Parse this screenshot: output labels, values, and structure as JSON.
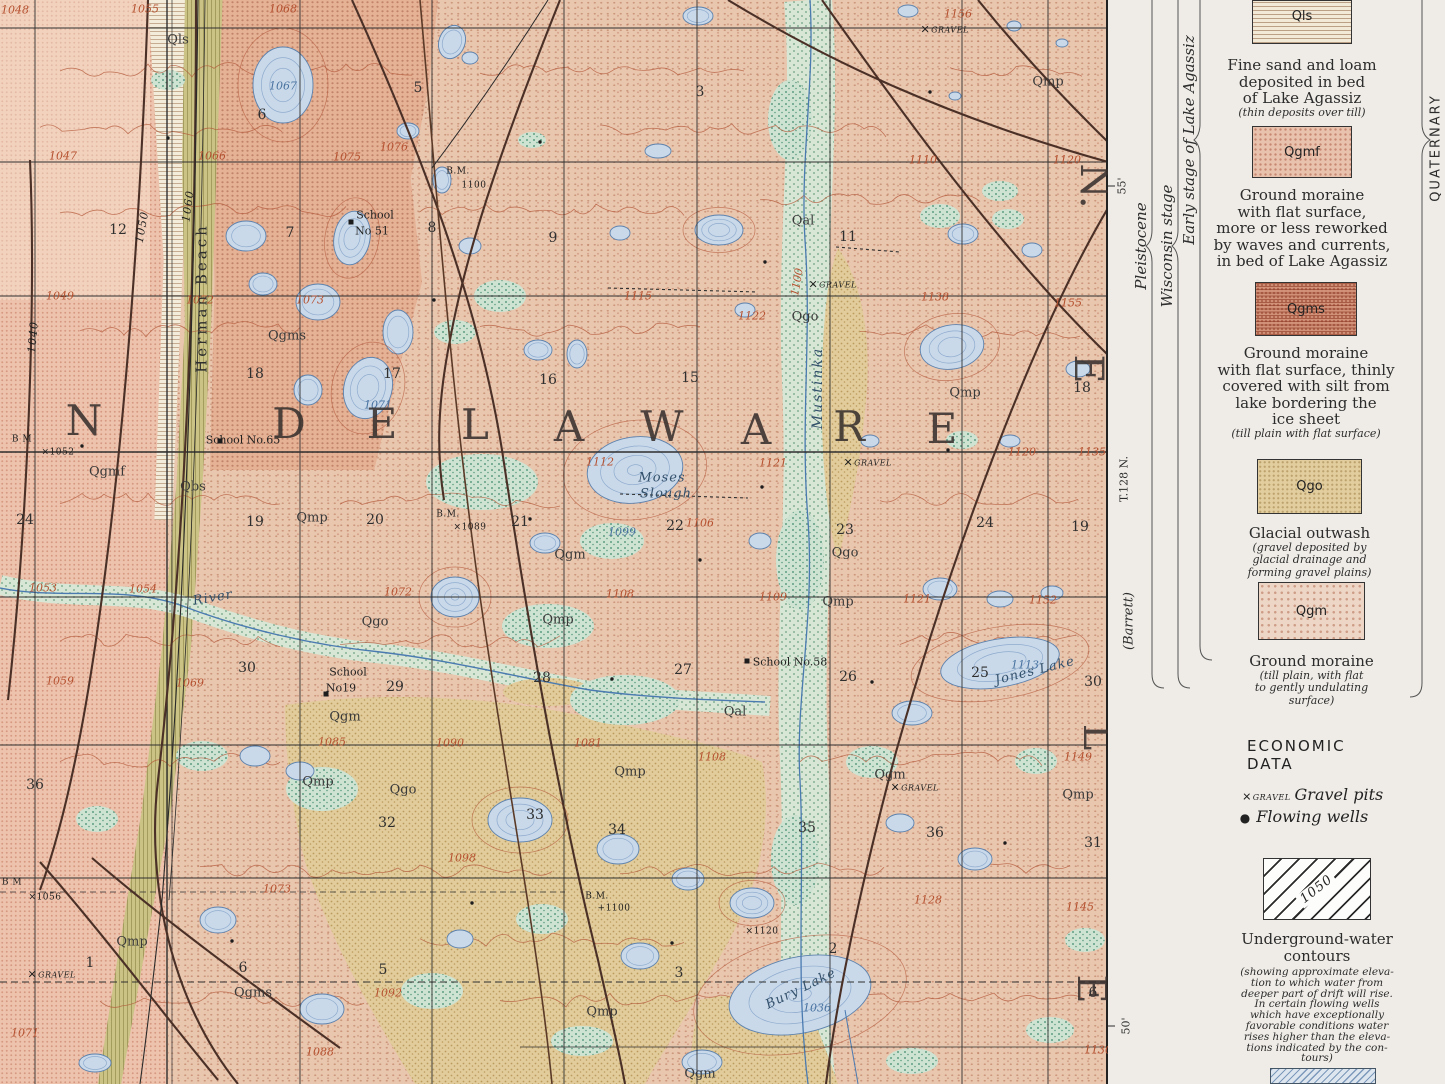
{
  "map": {
    "township_name_letters": [
      {
        "t": "N",
        "x": 85,
        "y": 421
      },
      {
        "t": "D",
        "x": 290,
        "y": 424
      },
      {
        "t": "E",
        "x": 383,
        "y": 424
      },
      {
        "t": "L",
        "x": 476,
        "y": 425
      },
      {
        "t": "A",
        "x": 570,
        "y": 427
      },
      {
        "t": "W",
        "x": 663,
        "y": 427
      },
      {
        "t": "A",
        "x": 757,
        "y": 430
      },
      {
        "t": "R",
        "x": 850,
        "y": 427
      },
      {
        "t": "E",
        "x": 943,
        "y": 429
      }
    ],
    "edge_letters": [
      {
        "t": "N.",
        "x": 1094,
        "y": 186
      },
      {
        "t": "E",
        "x": 1088,
        "y": 369
      },
      {
        "t": "L",
        "x": 1097,
        "y": 737
      },
      {
        "t": "E",
        "x": 1091,
        "y": 989
      }
    ],
    "water_names": [
      [
        "Moses",
        662,
        478,
        "w",
        0
      ],
      [
        "Slough",
        666,
        494,
        "w",
        0
      ],
      [
        "Jones Lake",
        1035,
        671,
        "w",
        -14
      ],
      [
        "Bury Lake",
        801,
        989,
        "w",
        -26
      ],
      [
        "River",
        213,
        598,
        "w",
        -10
      ],
      [
        "Herman Beach",
        202,
        298,
        "vw",
        -90
      ],
      [
        "Mustinka",
        818,
        388,
        "vwi",
        -90
      ]
    ],
    "schools": [
      [
        "School",
        375,
        215
      ],
      [
        "No 51",
        372,
        231
      ],
      [
        "School No.65",
        243,
        440
      ],
      [
        "School",
        348,
        672
      ],
      [
        "No19",
        341,
        688
      ],
      [
        "School No.58",
        790,
        662
      ]
    ],
    "unit_labels": [
      [
        "Qls",
        178,
        40
      ],
      [
        "Qmp",
        1048,
        82
      ],
      [
        "Qal",
        803,
        221
      ],
      [
        "Qgo",
        805,
        317
      ],
      [
        "Qgms",
        287,
        336
      ],
      [
        "Qgmf",
        107,
        472
      ],
      [
        "Qbs",
        193,
        487
      ],
      [
        "Qmp",
        312,
        518
      ],
      [
        "Qgm",
        570,
        555
      ],
      [
        "Qgo",
        845,
        553
      ],
      [
        "Qgo",
        375,
        622
      ],
      [
        "Qmp",
        558,
        620
      ],
      [
        "Qmp",
        838,
        602
      ],
      [
        "Qmp",
        965,
        393
      ],
      [
        "Qgm",
        345,
        717
      ],
      [
        "Qal",
        735,
        712
      ],
      [
        "Qmp",
        318,
        782
      ],
      [
        "Qmp",
        630,
        772
      ],
      [
        "Qgo",
        403,
        790
      ],
      [
        "Qgm",
        890,
        775
      ],
      [
        "Qmp",
        1078,
        795
      ],
      [
        "Qmp",
        132,
        942
      ],
      [
        "Qgms",
        253,
        993
      ],
      [
        "Qmp",
        602,
        1012
      ],
      [
        "Qgm",
        700,
        1074
      ]
    ],
    "contour_elevations_red": [
      [
        "1048",
        15,
        10
      ],
      [
        "1055",
        145,
        9
      ],
      [
        "1068",
        283,
        9
      ],
      [
        "1047",
        63,
        156
      ],
      [
        "1066",
        212,
        156
      ],
      [
        "1075",
        347,
        157
      ],
      [
        "1076",
        394,
        147
      ],
      [
        "1049",
        60,
        296
      ],
      [
        "1072",
        200,
        300
      ],
      [
        "1073",
        310,
        300
      ],
      [
        "1115",
        638,
        296
      ],
      [
        "1122",
        752,
        316
      ],
      [
        "1138",
        935,
        297
      ],
      [
        "1155",
        1068,
        303
      ],
      [
        "1110",
        923,
        160
      ],
      [
        "1120",
        1067,
        160
      ],
      [
        "1156",
        958,
        14
      ],
      [
        "1112",
        600,
        462
      ],
      [
        "1121",
        773,
        463
      ],
      [
        "1120",
        1022,
        452
      ],
      [
        "1135",
        1092,
        452
      ],
      [
        "1106",
        700,
        523
      ],
      [
        "1108",
        620,
        594
      ],
      [
        "1109",
        773,
        597
      ],
      [
        "1121",
        917,
        599
      ],
      [
        "1152",
        1043,
        600
      ],
      [
        "1053",
        43,
        588
      ],
      [
        "1054",
        143,
        589
      ],
      [
        "1072",
        398,
        592
      ],
      [
        "1059",
        60,
        681
      ],
      [
        "1069",
        190,
        683
      ],
      [
        "1085",
        332,
        742
      ],
      [
        "1090",
        450,
        743
      ],
      [
        "1081",
        588,
        743
      ],
      [
        "1108",
        712,
        757
      ],
      [
        "1149",
        1078,
        757
      ],
      [
        "1073",
        277,
        889
      ],
      [
        "1128",
        928,
        900
      ],
      [
        "1145",
        1080,
        907
      ],
      [
        "1098",
        462,
        858
      ],
      [
        "1092",
        388,
        993
      ],
      [
        "1088",
        320,
        1052
      ],
      [
        "1071",
        25,
        1033
      ],
      [
        "1130",
        1098,
        1050
      ],
      [
        "1100",
        797,
        282,
        -80
      ]
    ],
    "lake_depths_blue": [
      [
        "1067",
        283,
        86
      ],
      [
        "1071",
        378,
        405
      ],
      [
        "1099",
        622,
        532
      ],
      [
        "1113",
        1025,
        665
      ],
      [
        "1036",
        817,
        1008
      ]
    ],
    "underground_water_labels": [
      [
        "1040",
        33,
        337,
        -85
      ],
      [
        "1050",
        142,
        227,
        -80
      ],
      [
        "1060",
        188,
        206,
        -82
      ]
    ],
    "benchmarks": [
      [
        "B M",
        22,
        440
      ],
      [
        "×1052",
        58,
        453
      ],
      [
        "B.M.",
        458,
        172
      ],
      [
        "1100",
        474,
        186
      ],
      [
        "B.M.",
        448,
        515
      ],
      [
        "×1089",
        470,
        528
      ],
      [
        "B.M.",
        597,
        897
      ],
      [
        "+1100",
        614,
        909
      ],
      [
        "×1120",
        762,
        932
      ],
      [
        "B M",
        12,
        883
      ],
      [
        "×1056",
        45,
        898
      ]
    ],
    "section_numbers": [
      [
        "6",
        262,
        115
      ],
      [
        "5",
        418,
        88
      ],
      [
        "3",
        700,
        92
      ],
      [
        "12",
        118,
        230
      ],
      [
        "7",
        290,
        233
      ],
      [
        "8",
        432,
        228
      ],
      [
        "9",
        553,
        238
      ],
      [
        "11",
        848,
        237
      ],
      [
        "18",
        255,
        374
      ],
      [
        "17",
        392,
        374
      ],
      [
        "16",
        548,
        380
      ],
      [
        "15",
        690,
        378
      ],
      [
        "24",
        25,
        520
      ],
      [
        "19",
        255,
        522
      ],
      [
        "20",
        375,
        520
      ],
      [
        "21",
        520,
        522
      ],
      [
        "22",
        675,
        526
      ],
      [
        "23",
        845,
        530
      ],
      [
        "24",
        985,
        523
      ],
      [
        "18",
        1082,
        388
      ],
      [
        "19",
        1080,
        527
      ],
      [
        "30",
        247,
        668
      ],
      [
        "29",
        395,
        687
      ],
      [
        "28",
        542,
        678
      ],
      [
        "27",
        683,
        670
      ],
      [
        "26",
        848,
        677
      ],
      [
        "25",
        980,
        673
      ],
      [
        "30",
        1093,
        682
      ],
      [
        "36",
        35,
        785
      ],
      [
        "32",
        387,
        823
      ],
      [
        "33",
        535,
        815
      ],
      [
        "34",
        617,
        830
      ],
      [
        "35",
        807,
        828
      ],
      [
        "36",
        935,
        833
      ],
      [
        "31",
        1093,
        843
      ],
      [
        "1",
        90,
        963
      ],
      [
        "6",
        243,
        968
      ],
      [
        "5",
        383,
        970
      ],
      [
        "3",
        679,
        973
      ],
      [
        "2",
        833,
        949
      ],
      [
        "6",
        1093,
        993
      ]
    ],
    "gravel_pits": [
      [
        945,
        30
      ],
      [
        833,
        285
      ],
      [
        868,
        463
      ],
      [
        52,
        975
      ],
      [
        915,
        788
      ]
    ],
    "gravel_pit_text": "GRAVEL"
  },
  "margin": {
    "lat_top": "55'",
    "township_range": "T.128 N.",
    "town": "(Barrett)",
    "lat_bottom": "50'",
    "stages": [
      "Pleistocene",
      "Wisconsin stage",
      "Early stage of Lake Agassiz"
    ],
    "era": "QUATERNARY"
  },
  "legend": {
    "units": [
      {
        "code": "Qls",
        "swatch": "qls",
        "desc": [
          "Fine sand and loam",
          "deposited in bed",
          "of Lake Agassiz"
        ],
        "note": [
          "(thin deposits over till)"
        ]
      },
      {
        "code": "Qgmf",
        "swatch": "qgmf",
        "desc": [
          "Ground moraine",
          "with flat surface,",
          "more or less reworked",
          "by waves and currents,",
          "in bed of Lake Agassiz"
        ],
        "note": []
      },
      {
        "code": "Qgms",
        "swatch": "qgms",
        "desc": [
          "Ground moraine",
          "with flat surface, thinly",
          "covered with silt from",
          "lake bordering the",
          "ice sheet"
        ],
        "note": [
          "(till plain with flat surface)"
        ]
      },
      {
        "code": "Qgo",
        "swatch": "qgo",
        "desc": [
          "Glacial outwash"
        ],
        "note": [
          "(gravel deposited by",
          "glacial drainage and",
          "forming gravel plains)"
        ]
      },
      {
        "code": "Qgm",
        "swatch": "qgm",
        "desc": [
          "Ground moraine"
        ],
        "note": [
          "(till plain, with flat",
          "to gently undulating",
          "surface)"
        ]
      }
    ],
    "economic": {
      "heading": "ECONOMIC DATA",
      "gravel_symbol_text": "GRAVEL",
      "gravel_label": "Gravel pits",
      "wells_label": "Flowing wells"
    },
    "uw": {
      "box_label": "1050",
      "title": [
        "Underground-water",
        "contours"
      ],
      "note": [
        "(showing approximate eleva-",
        "tion to which water from",
        "deeper part of drift will rise.",
        "In certain flowing wells",
        "which have exceptionally",
        "favorable conditions water",
        "rises higher than the eleva-",
        "tions indicated by the con-",
        "tours)"
      ]
    }
  },
  "colors": {
    "ground_moraine_pink": "#e9c6ae",
    "outwash_tan": "#e2cd9e",
    "beach_olive": "#cbc386",
    "lake_blue": "#c9d9ea",
    "marsh_green": "#d3e5d6",
    "contour_red": "#b3583a",
    "uw_contour_dark": "#4a3026"
  }
}
